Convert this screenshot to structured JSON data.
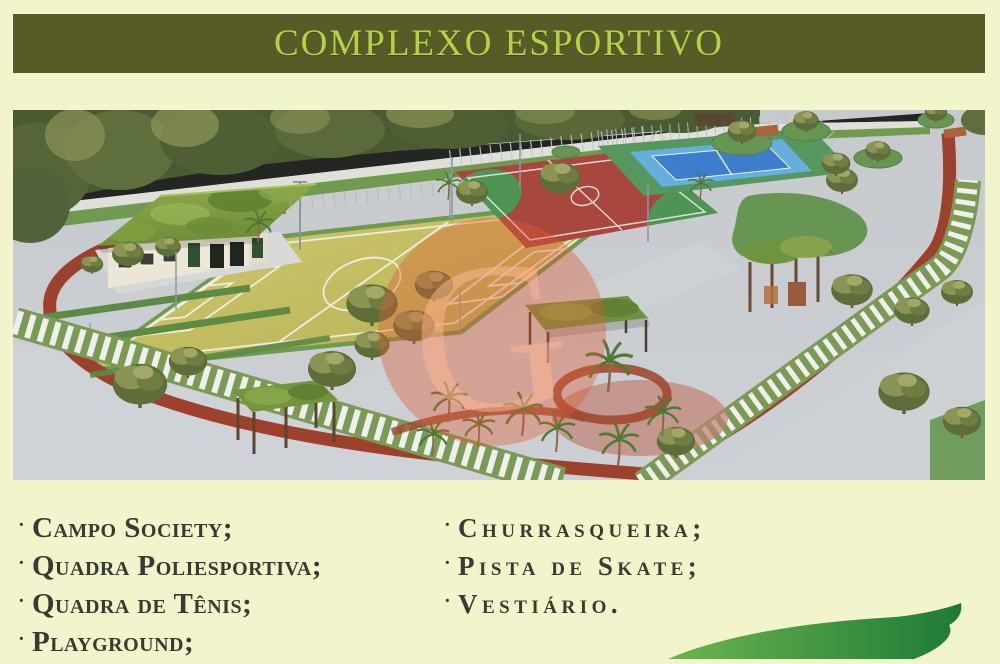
{
  "page": {
    "background_color": "#f2f5cb"
  },
  "banner": {
    "title": "COMPLEXO ESPORTIVO",
    "background_color": "#575c26",
    "text_color": "#b9cf49"
  },
  "illustration": {
    "description": "Aerial 3D rendering of the sports complex: soccer field, multi-sport court, tennis court, clubhouse with grass roof, running track, pergolas, palm trees and walkways",
    "watermark_letter": "G"
  },
  "amenities": {
    "bullet": "·",
    "left": [
      "Campo Society;",
      "Quadra Poliesportiva;",
      "Quadra de Tênis;",
      "Playground;"
    ],
    "right": [
      "Churrasqueira;",
      "Pista de Skate;",
      "Vestiário."
    ]
  },
  "leaf": {
    "color_start": "#6db54f",
    "color_end": "#1d7a36"
  }
}
